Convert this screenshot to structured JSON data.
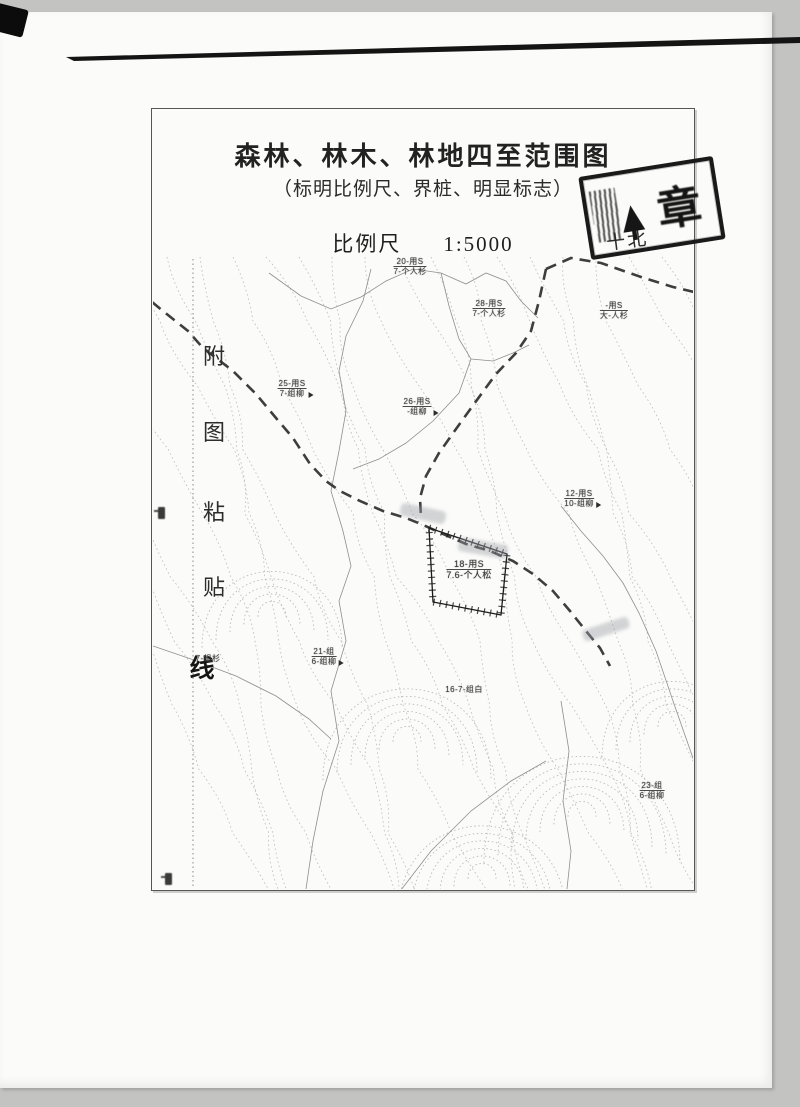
{
  "document": {
    "title": "森林、林木、林地四至范围图",
    "subtitle": "（标明比例尺、界桩、明显标志）",
    "scale_label": "比例尺",
    "scale_value": "1:5000",
    "paste_line_text": "附图粘贴线"
  },
  "stamp": {
    "visible_char": "章",
    "handwritten_note": "十北"
  },
  "map": {
    "boundary_parcel": {
      "top": "18-用S",
      "bottom": "7.6-个人松"
    },
    "labels": [
      {
        "x": 258,
        "y": 148,
        "top": "20-用S",
        "bottom": "7-个人杉",
        "flag": false,
        "big": false
      },
      {
        "x": 337,
        "y": 190,
        "top": "28-用S",
        "bottom": "7-个人杉",
        "flag": false,
        "big": false
      },
      {
        "x": 462,
        "y": 192,
        "top": "-用S",
        "bottom": "大-人杉",
        "flag": false,
        "big": false
      },
      {
        "x": 140,
        "y": 270,
        "top": "25-用S",
        "bottom": "7-组柳",
        "flag": true,
        "big": false
      },
      {
        "x": 265,
        "y": 288,
        "top": "26-用S",
        "bottom": "-组柳",
        "flag": true,
        "big": false
      },
      {
        "x": 427,
        "y": 380,
        "top": "12-用S",
        "bottom": "10-组柳",
        "flag": true,
        "big": false
      },
      {
        "x": 317,
        "y": 450,
        "top": "18-用S",
        "bottom": "7.6-个人松",
        "flag": false,
        "big": true
      },
      {
        "x": 56,
        "y": 545,
        "top": "7-组杉",
        "bottom": "",
        "flag": false,
        "big": false
      },
      {
        "x": 172,
        "y": 538,
        "top": "21-组",
        "bottom": "6-组柳",
        "flag": true,
        "big": false
      },
      {
        "x": 312,
        "y": 576,
        "top": "16-7-组白",
        "bottom": "",
        "flag": false,
        "big": false
      },
      {
        "x": 500,
        "y": 672,
        "top": "23-组",
        "bottom": "6-组柳",
        "flag": false,
        "big": false
      }
    ]
  },
  "colors": {
    "page_bg": "#fbfbf9",
    "scan_bg": "#c3c3c1",
    "ink": "#222222",
    "contour": "#bcbcba",
    "road": "#2e2e2e",
    "stamp_ink": "#1a1a1a"
  }
}
